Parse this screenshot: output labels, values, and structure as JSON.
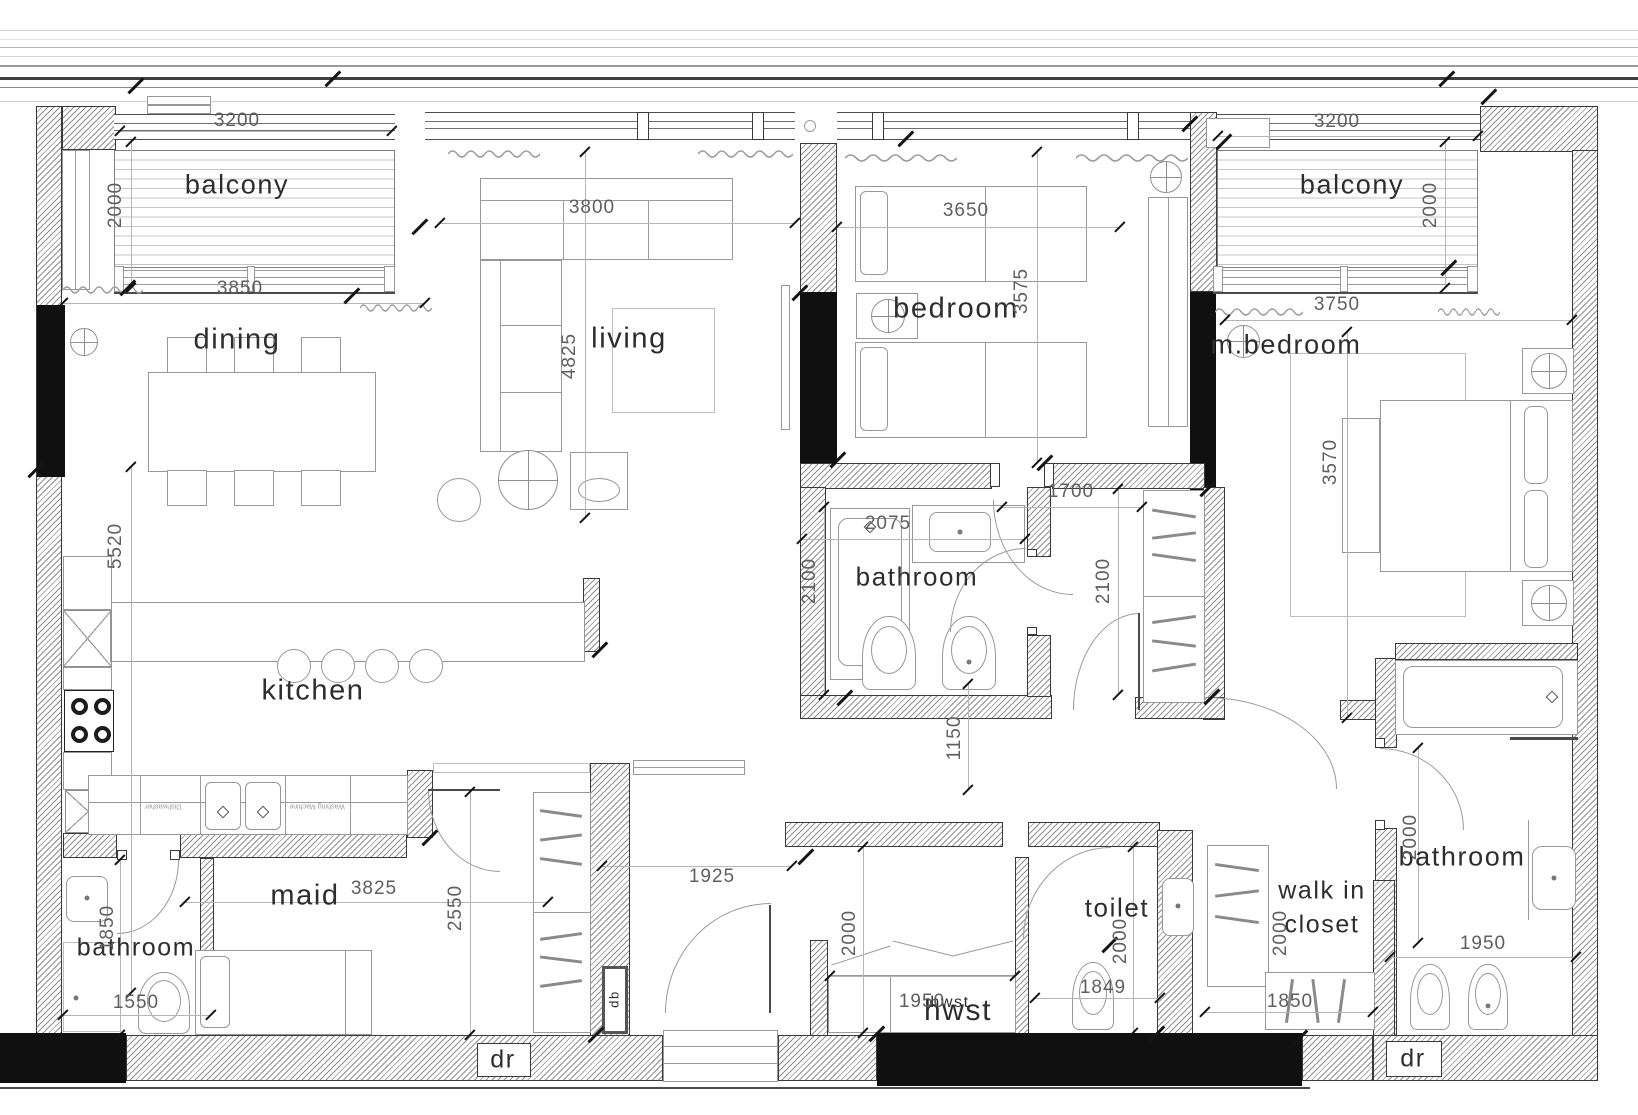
{
  "colors": {
    "wall_hatch": "#8f8f8f",
    "solid_column": "#101010",
    "dim_text": "#5f5f5f",
    "label_text": "#2d2d2d"
  },
  "rooms": {
    "balcony_l": "balcony",
    "dining": "dining",
    "living": "living",
    "bedroom": "bedroom",
    "balcony_r": "balcony",
    "mbedroom": "m.bedroom",
    "bath_mid": "bathroom",
    "kitchen": "kitchen",
    "maid": "maid",
    "bath_left": "bathroom",
    "toilet": "toilet",
    "walkin1": "walk in",
    "walkin2": "closet",
    "bath_right": "bathroom",
    "hwst": "hwst",
    "hwst_small": "hwst",
    "dr_left": "dr",
    "dr_right": "dr",
    "db": "db"
  },
  "appliances": {
    "dishwasher": "Dishwasher",
    "washing_machine": "Washing Machine"
  },
  "dims": {
    "balcony_l_w": "3200",
    "balcony_l_d": "2000",
    "dining_w": "3850",
    "living_w": "3800",
    "living_h": "4825",
    "bedroom_w": "3650",
    "bedroom_h": "3575",
    "balcony_r_w": "3200",
    "balcony_r_d": "2000",
    "mbedroom_w": "3750",
    "mbedroom_h": "3570",
    "bath_mid_w": "2075",
    "bath_mid_h": "2100",
    "closet_w": "1700",
    "closet_h": "2100",
    "kitchen_h": "5520",
    "corridor_w": "1150",
    "hall_w": "1925",
    "maid_w": "3825",
    "maid_h": "2550",
    "bath_left_w": "1550",
    "bath_left_h": "1850",
    "hwst_h": "2000",
    "hwst_w": "1950",
    "toilet_h": "2000",
    "toilet_w": "1849",
    "walkin_h": "2000",
    "walkin_w": "1850",
    "bath_right_h": "2000",
    "bath_right_w": "1950"
  }
}
